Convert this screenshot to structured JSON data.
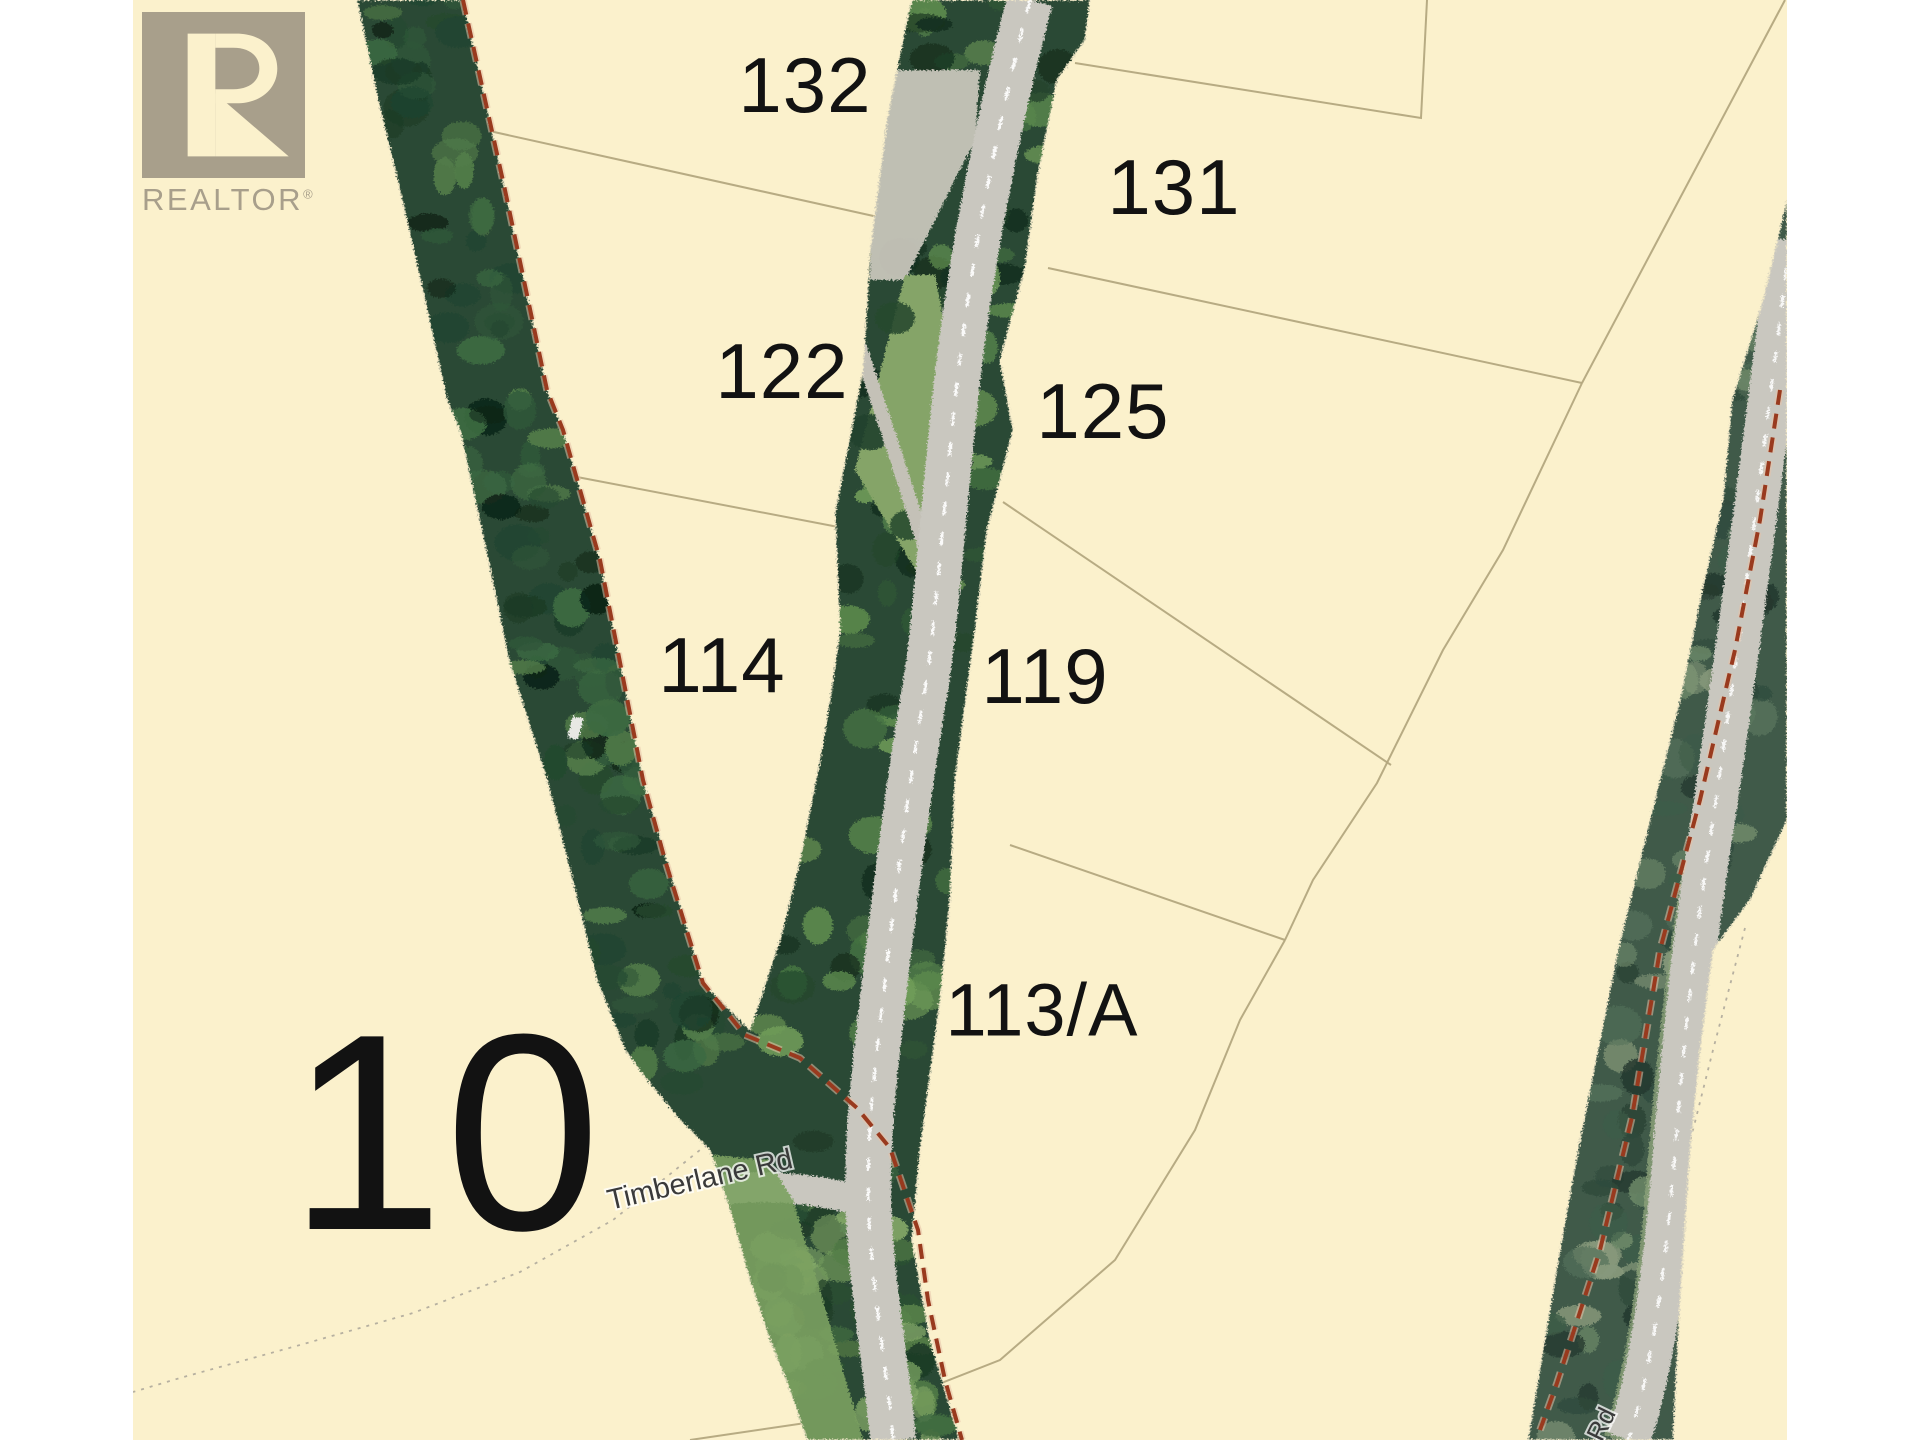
{
  "map": {
    "parcel_labels": [
      {
        "id": "132",
        "text": "132"
      },
      {
        "id": "131",
        "text": "131"
      },
      {
        "id": "122",
        "text": "122"
      },
      {
        "id": "125",
        "text": "125"
      },
      {
        "id": "114",
        "text": "114"
      },
      {
        "id": "119",
        "text": "119"
      },
      {
        "id": "113A",
        "text": "113/A"
      },
      {
        "id": "10",
        "text": "10"
      }
    ],
    "road_labels": [
      {
        "id": "timberlane",
        "text": "Timberlane Rd"
      },
      {
        "id": "rd-partial",
        "text": "Rd"
      }
    ]
  },
  "logo": {
    "mark": "R",
    "brand": "REALTOR",
    "registered": "®"
  },
  "colors": {
    "background": "#ffffff",
    "parcel_fill": "#fbf1cc",
    "parcel_line": "#b3a67e",
    "dotted_line": "#b6b0a0",
    "boundary_red": "#993a1e",
    "label_color": "#121212",
    "road_label_color": "#3a3a3a",
    "logo_taupe": "#a89f8b",
    "road_gray": "#c9c7bf",
    "tree_dark": "#1c3a27"
  }
}
